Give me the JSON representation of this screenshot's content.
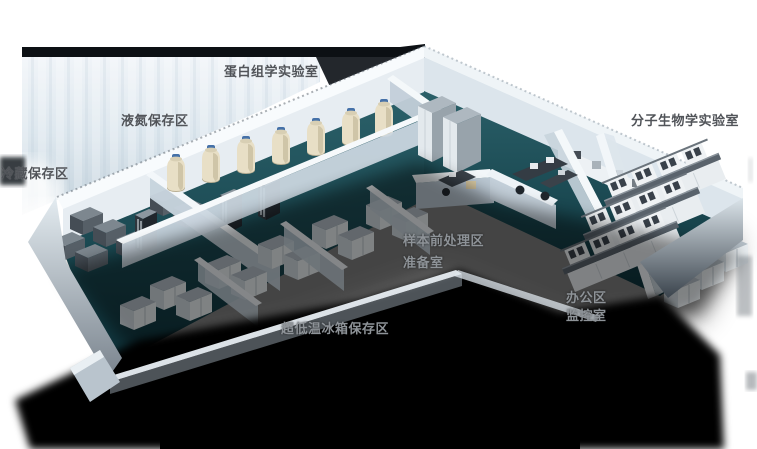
{
  "scene": {
    "kind": "isometric-cutaway-floorplan",
    "palette": {
      "floor_teal": "#1d4b54",
      "wall_top_white": "#f6fafc",
      "wall_face_light": "#e3ebf1",
      "wall_face_shade": "#bfccd6",
      "backdrop_blue": "#cdd9e2",
      "top_band_dark": "#0c1014",
      "shadow_black": "#000000",
      "freezer_gray": "#5f6870",
      "cabinet_white": "#e9eef1",
      "tank_cream": "#e8dfc6",
      "tank_cap_blue": "#4571a8",
      "bench_top_gray": "#5a636c",
      "label_dark": "#515459",
      "label_light": "#8e9398"
    }
  },
  "labels": [
    {
      "id": "proteomics-lab",
      "text": "蛋白组学实验室",
      "x": 224,
      "y": 61,
      "tone": "dark"
    },
    {
      "id": "liquid-nitrogen-area",
      "text": "液氮保存区",
      "x": 121,
      "y": 110,
      "tone": "dark"
    },
    {
      "id": "cold-storage-area",
      "text": "冷藏保存区",
      "x": 1,
      "y": 163,
      "tone": "dark"
    },
    {
      "id": "molecular-biology-lab",
      "text": "分子生物学实验室",
      "x": 631,
      "y": 110,
      "tone": "dark"
    },
    {
      "id": "sample-pretreatment-area",
      "text": "样本前处理区",
      "x": 403,
      "y": 230,
      "tone": "light"
    },
    {
      "id": "preparation-room",
      "text": "准备室",
      "x": 403,
      "y": 252,
      "tone": "light"
    },
    {
      "id": "office-area",
      "text": "办公区",
      "x": 566,
      "y": 287,
      "tone": "light"
    },
    {
      "id": "monitoring-room",
      "text": "监控室",
      "x": 566,
      "y": 305,
      "tone": "light"
    },
    {
      "id": "ult-freezer-storage-area",
      "text": "超低温冰箱保存区",
      "x": 281,
      "y": 318,
      "tone": "light"
    }
  ]
}
